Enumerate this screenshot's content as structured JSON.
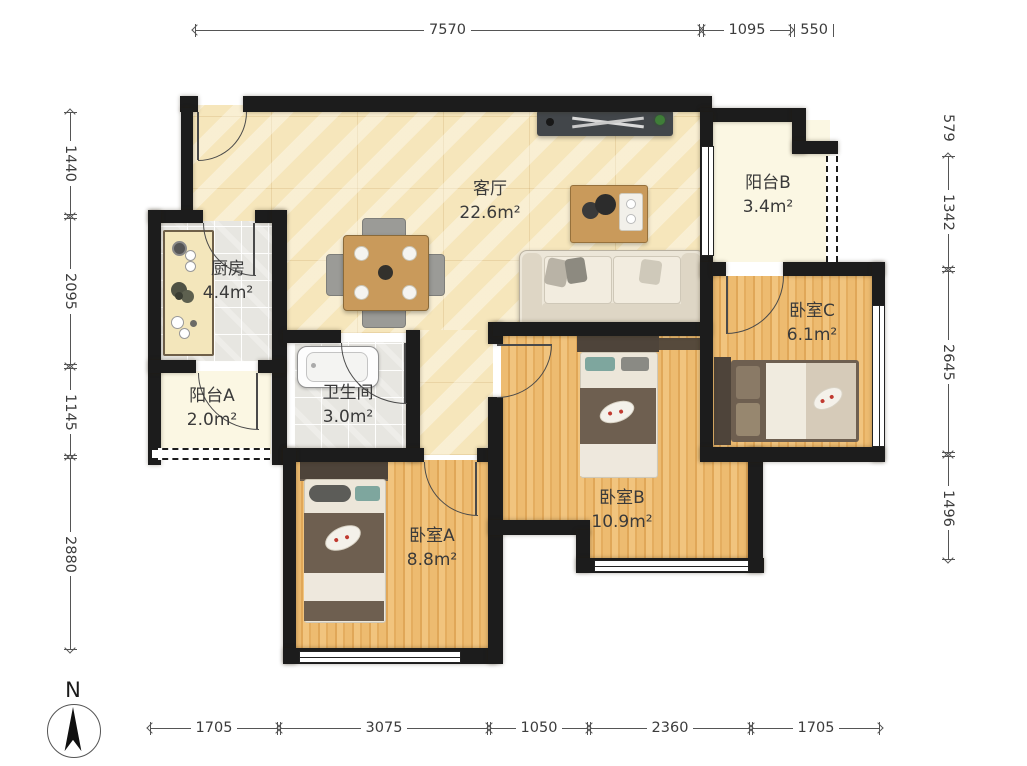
{
  "compass": {
    "label": "N"
  },
  "rooms": [
    {
      "name": "客厅",
      "area": "22.6m²"
    },
    {
      "name": "厨房",
      "area": "4.4m²"
    },
    {
      "name": "卫生间",
      "area": "3.0m²"
    },
    {
      "name": "阳台A",
      "area": "2.0m²"
    },
    {
      "name": "阳台B",
      "area": "3.4m²"
    },
    {
      "name": "卧室A",
      "area": "8.8m²"
    },
    {
      "name": "卧室B",
      "area": "10.9m²"
    },
    {
      "name": "卧室C",
      "area": "6.1m²"
    }
  ],
  "dimensions": {
    "top": [
      "7570",
      "1095",
      "550"
    ],
    "bottom": [
      "1705",
      "3075",
      "1050",
      "2360",
      "1705"
    ],
    "left": [
      "1440",
      "2095",
      "1145",
      "2880"
    ],
    "right": [
      "579",
      "1342",
      "2645",
      "1496"
    ]
  },
  "colors": {
    "wall": "#1c1c1c",
    "marble_floor": "#f6e6bb",
    "wood_floor": "#e8b265",
    "tile_floor": "#e7e6e1",
    "balcony_floor": "#fbf7e3"
  }
}
